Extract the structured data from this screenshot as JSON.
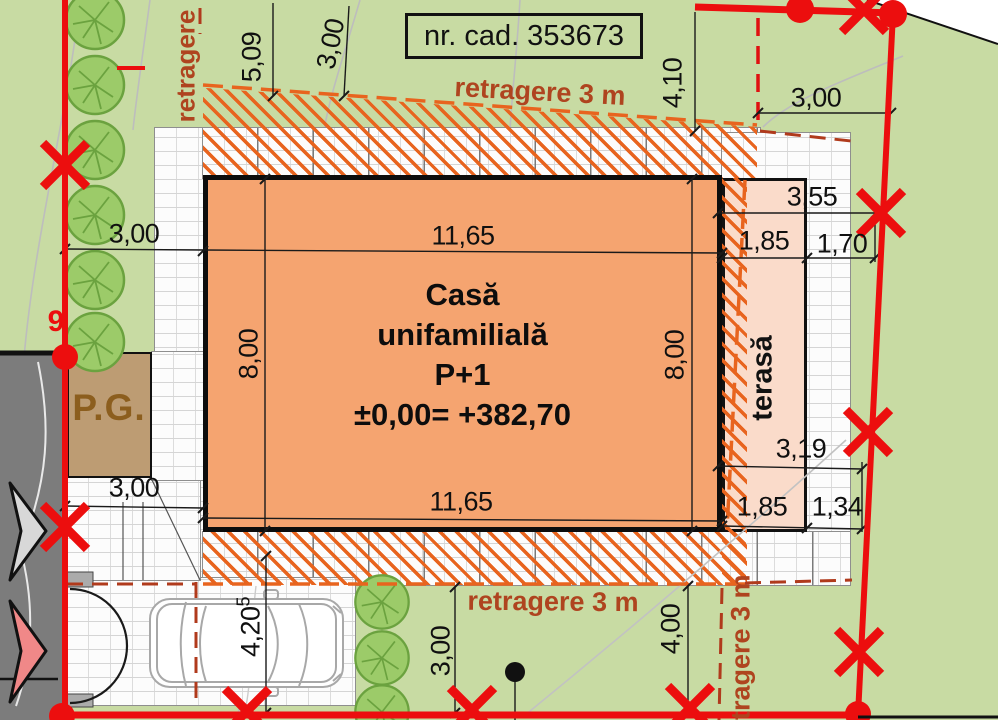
{
  "cadastral": {
    "label": "nr. cad. 353673"
  },
  "house": {
    "line1": "Casă",
    "line2": "unifamilială",
    "line3": "P+1",
    "line4": "±0,00= +382,70"
  },
  "terrace": {
    "label": "terasă"
  },
  "garage": {
    "label": "P.G."
  },
  "parcel": {
    "point_label": "9"
  },
  "setbacks": {
    "top": "retragere 3 m",
    "bottom": "retragere 3 m",
    "right_vertical": "retragere 3 m",
    "left_vertical": "retragere"
  },
  "dimensions": [
    {
      "label": "5,09"
    },
    {
      "label": "3,00"
    },
    {
      "label": "4,10"
    },
    {
      "label": "3,00"
    },
    {
      "label": "3,55"
    },
    {
      "label": "1,85"
    },
    {
      "label": "1,70"
    },
    {
      "label": "3,00"
    },
    {
      "label": "11,65"
    },
    {
      "label": "8,00"
    },
    {
      "label": "8,00"
    },
    {
      "label": "3,00"
    },
    {
      "label": "11,65"
    },
    {
      "label": "3,19"
    },
    {
      "label": "1,85"
    },
    {
      "label": "1,34"
    },
    {
      "label": "4,20",
      "sup": "5"
    },
    {
      "label": "3,00"
    },
    {
      "label": "4,00"
    }
  ],
  "colors": {
    "boundary_red": "#EC0E0E",
    "setback_text_red": "#AF441F",
    "hatch_orange": "#E8641E",
    "house_orange": "#F5A470",
    "terrace_pink": "#FADBCA",
    "grass_green": "#C8DBA3",
    "road_gray": "#7C7C7C",
    "garage_tan": "#BD9C73",
    "tree_green": "#9CCB69"
  }
}
